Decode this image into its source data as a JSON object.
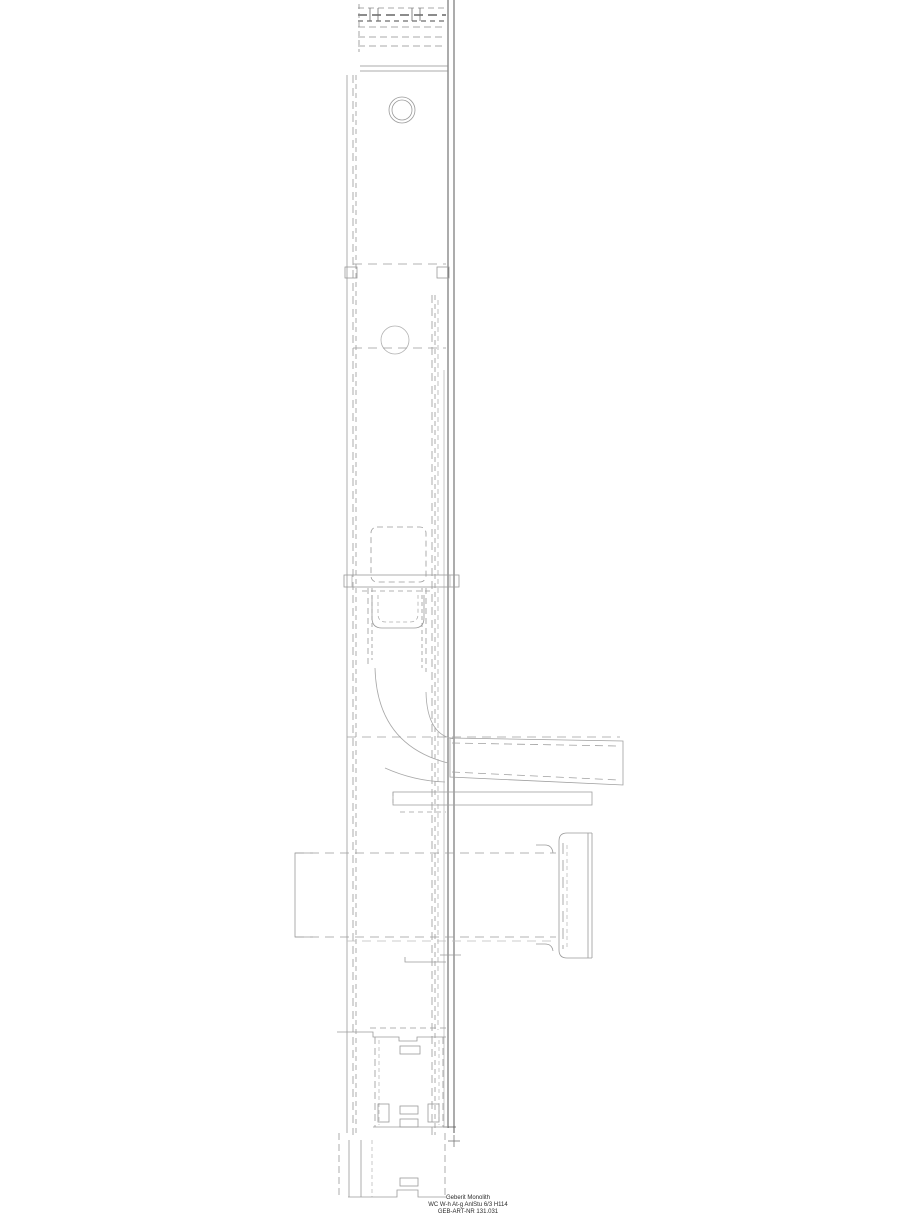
{
  "title_block": {
    "line1": "Geberit Monolith",
    "line2": "WC W-h At-g AnlStu 6/3 H114",
    "line3": "GEB-ART-NR 131.031"
  },
  "drawing": {
    "type": "cad-side-elevation",
    "background_color": "#ffffff",
    "line_color_light": "#9a9a9a",
    "line_color_dark": "#5a5a5a",
    "text_color": "#2b2b2b"
  }
}
